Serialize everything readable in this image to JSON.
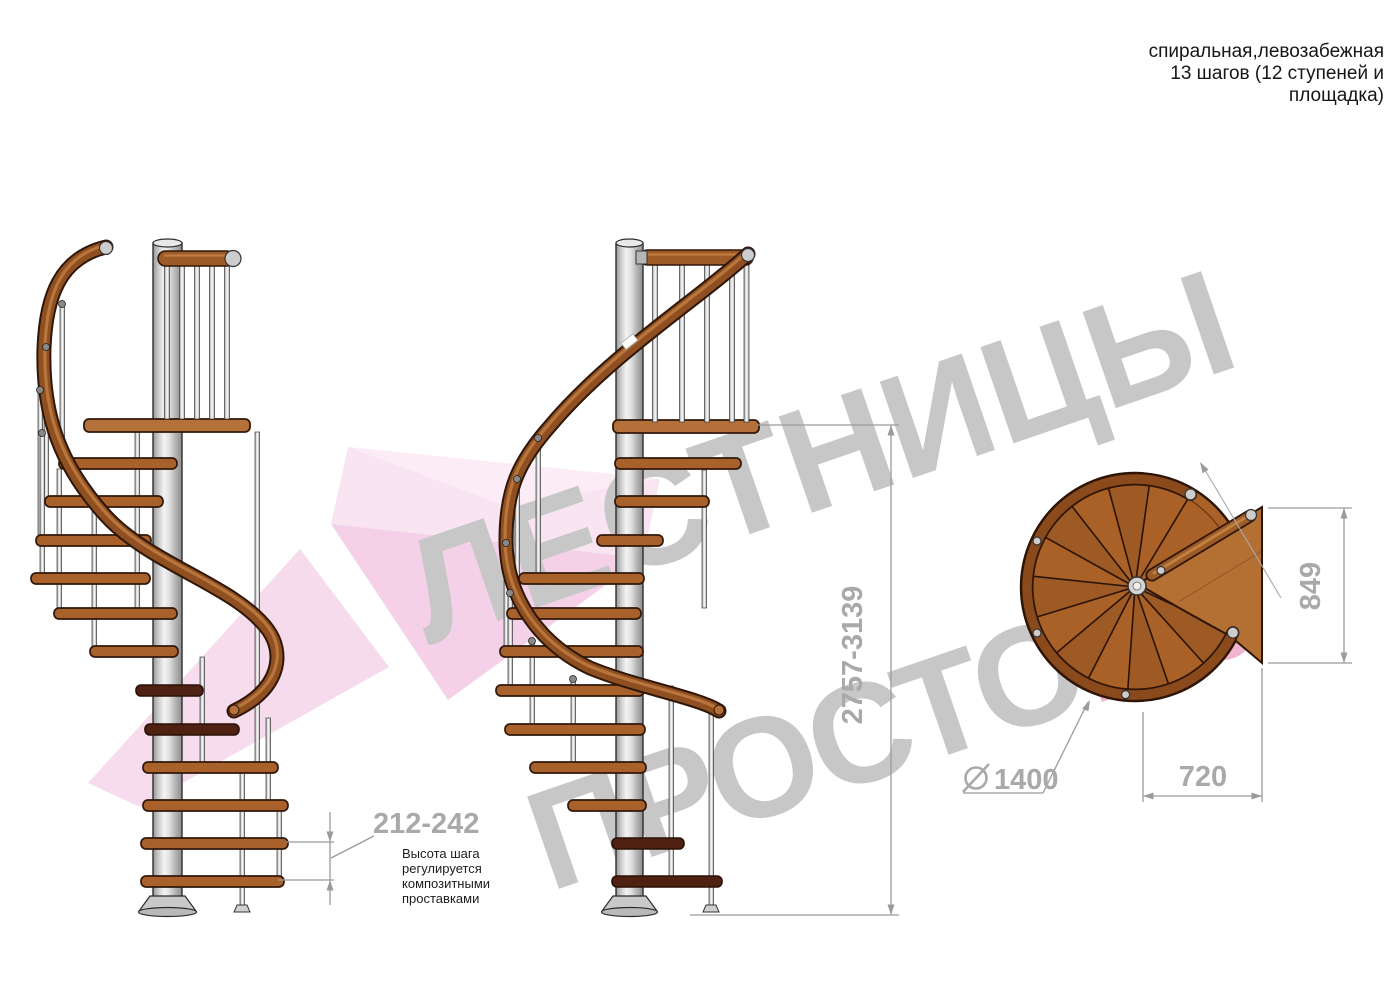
{
  "header": {
    "line1": "спиральная,левозабежная",
    "line2": "13 шагов (12 ступеней и",
    "line3": "площадка)"
  },
  "watermark": {
    "word1": "ЛЕСТНИЦЫ",
    "word2": "ПРОСТО",
    "word2_suffix": ".РУ"
  },
  "annotations": {
    "step_height": {
      "value": "212-242",
      "notes": [
        "Высота шага",
        "регулируется",
        "композитными",
        "проставками"
      ]
    },
    "total_height": {
      "value": "2757-3139"
    },
    "plan": {
      "platform_depth": "849",
      "platform_width": "720",
      "diameter": "1400"
    }
  },
  "colors": {
    "wood": "#a8612b",
    "wood_dark": "#4e2113",
    "handrail": "#8f4f20",
    "metal": "#cdcdcd",
    "dimension_line": "#9b9b9b",
    "dimension_text": "#a9a9a9",
    "watermark_gray": "#c7c7c7",
    "watermark_pink": "#f0b4cf",
    "arrow_pink": "#f6d8ec"
  }
}
